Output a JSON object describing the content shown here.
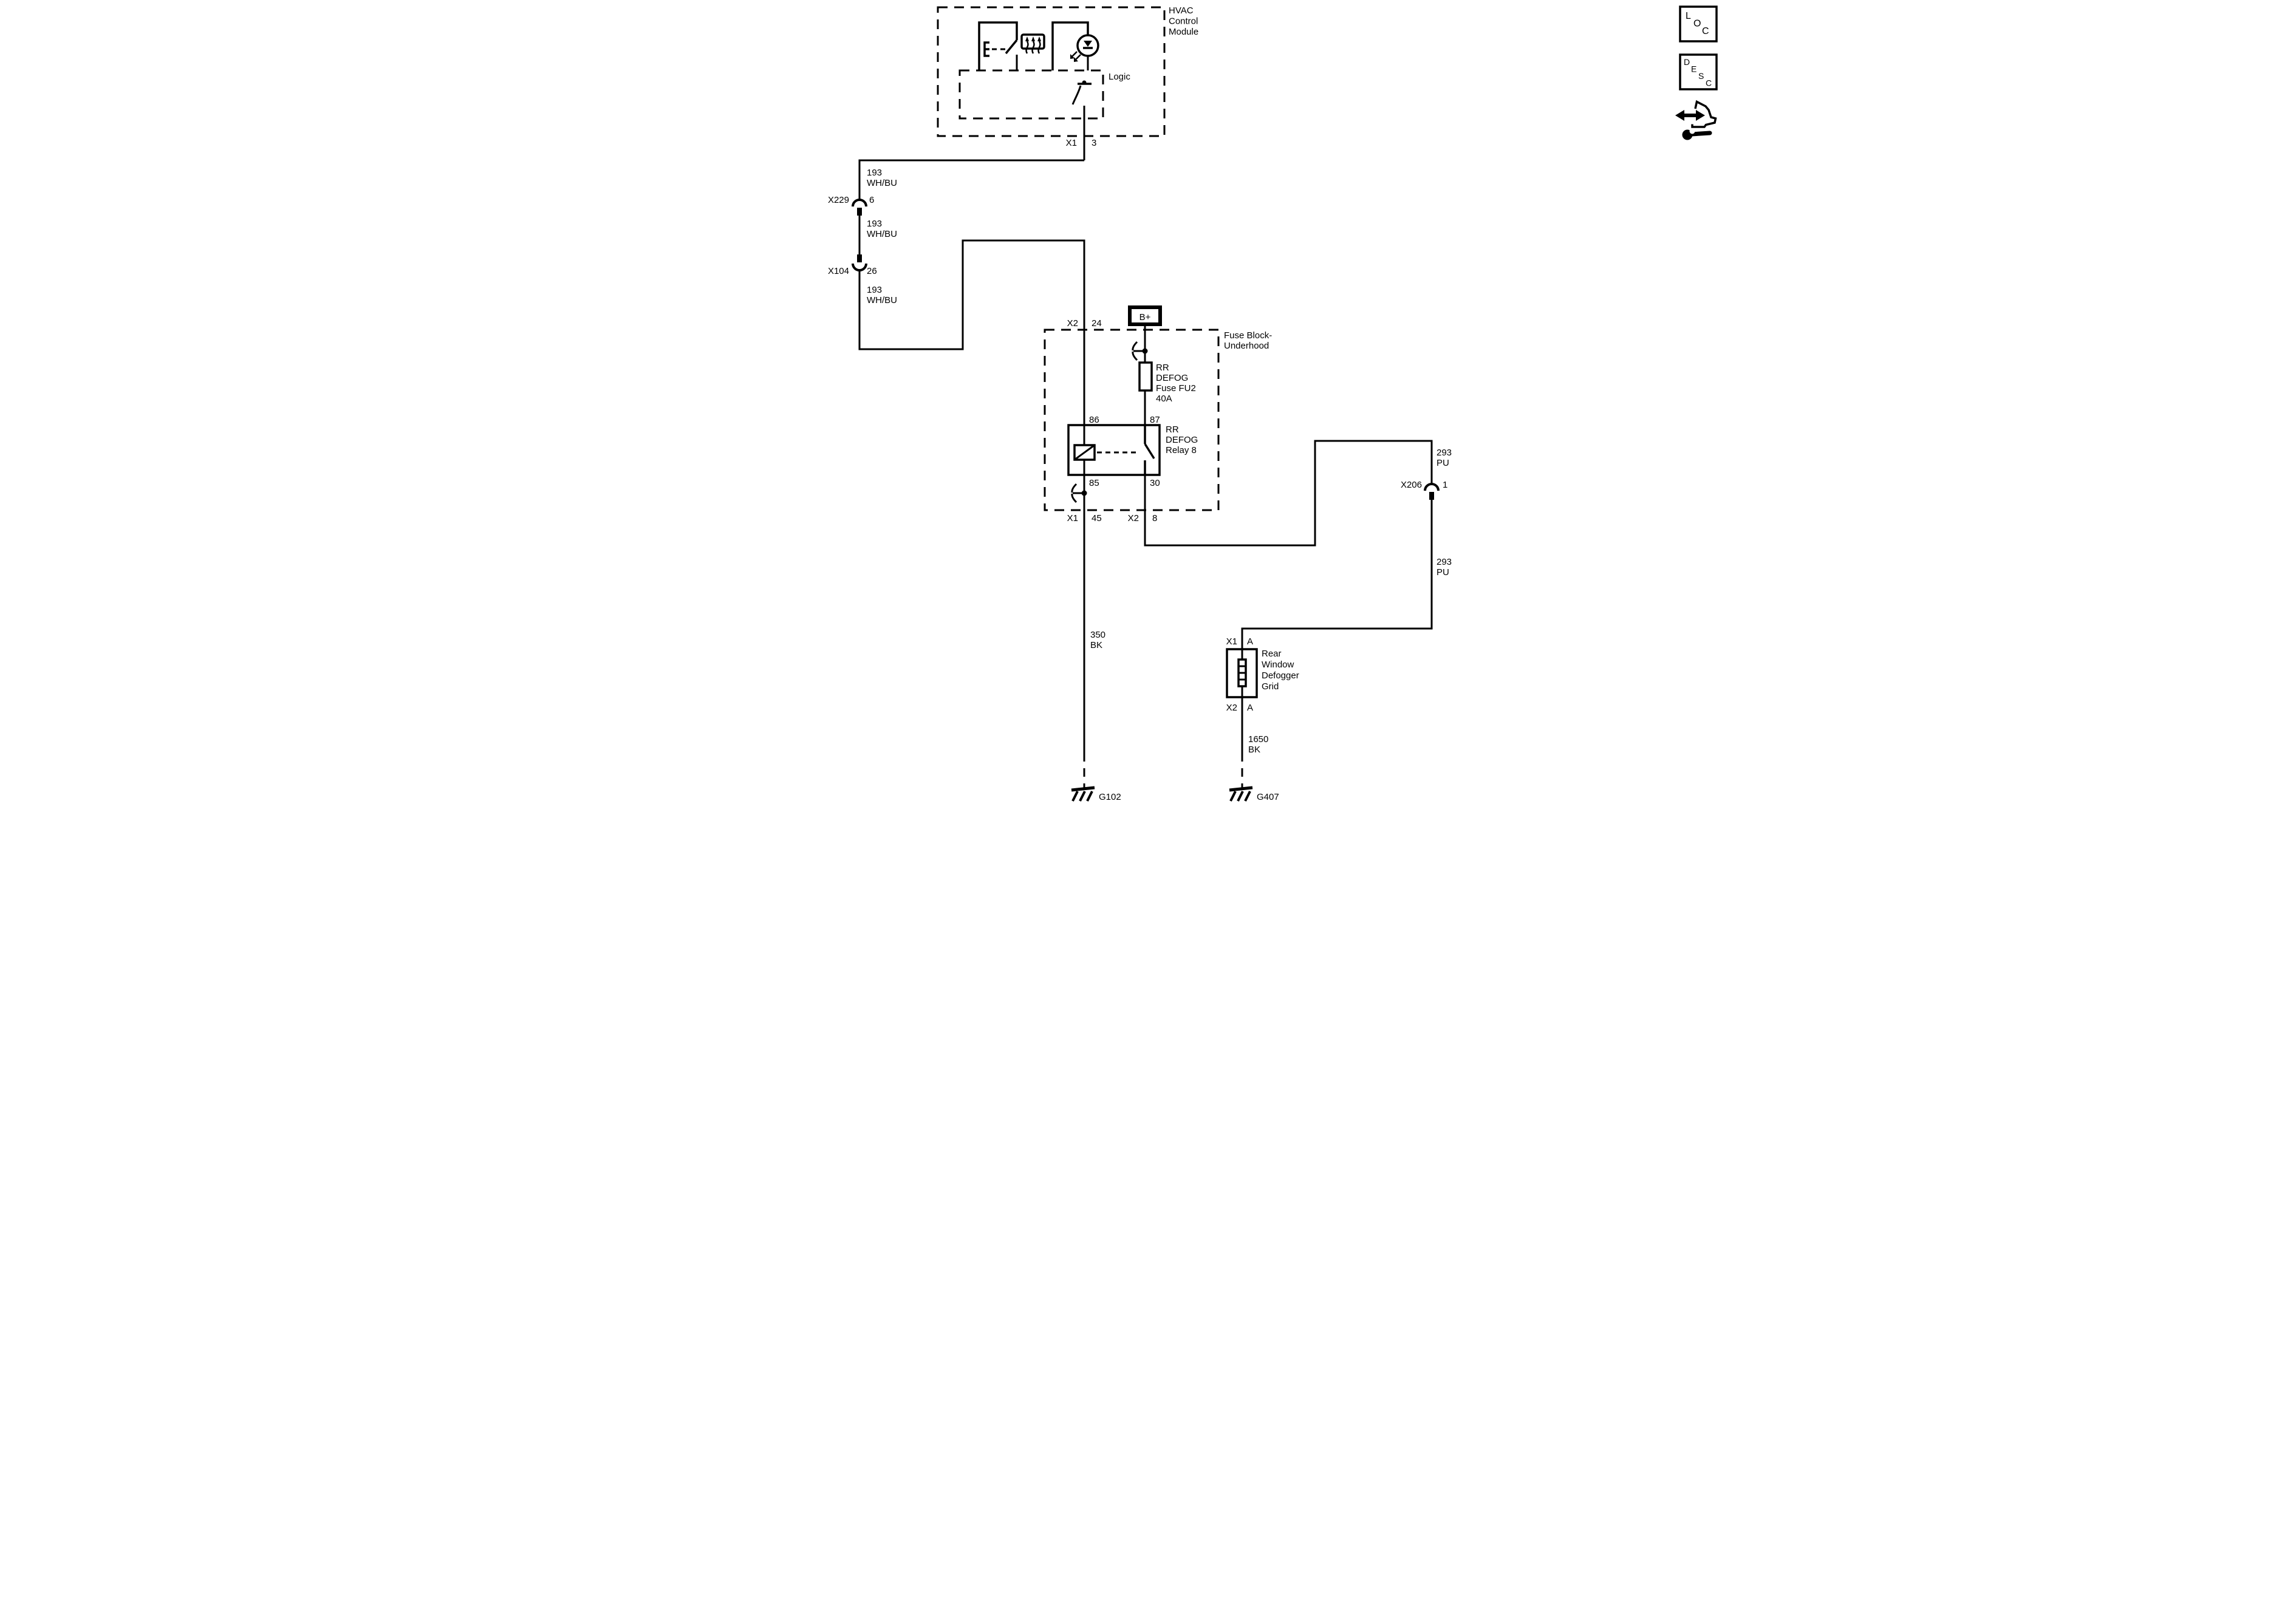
{
  "corner_panel": {
    "loc_letters": [
      "L",
      "O",
      "C"
    ],
    "desc_letters": [
      "D",
      "E",
      "S",
      "C"
    ]
  },
  "hvac_module": {
    "name_lines": [
      "HVAC",
      "Control",
      "Module"
    ],
    "logic_label": "Logic",
    "exit_connector": "X1",
    "exit_pin": "3"
  },
  "wires": {
    "w193_1": {
      "circuit": "193",
      "color": "WH/BU"
    },
    "w193_2": {
      "circuit": "193",
      "color": "WH/BU"
    },
    "w193_3": {
      "circuit": "193",
      "color": "WH/BU"
    },
    "w350": {
      "circuit": "350",
      "color": "BK"
    },
    "w293_1": {
      "circuit": "293",
      "color": "PU"
    },
    "w293_2": {
      "circuit": "293",
      "color": "PU"
    },
    "w1650": {
      "circuit": "1650",
      "color": "BK"
    }
  },
  "connectors": {
    "x229": {
      "name": "X229",
      "pin": "6"
    },
    "x104": {
      "name": "X104",
      "pin": "26"
    },
    "x206": {
      "name": "X206",
      "pin": "1"
    }
  },
  "fuse_block": {
    "name_lines": [
      "Fuse Block-",
      "Underhood"
    ],
    "entry_connector": "X2",
    "entry_pin": "24",
    "battery_label": "B+",
    "fuse_lines": [
      "RR",
      "DEFOG",
      "Fuse FU2",
      "40A"
    ],
    "relay_lines": [
      "RR",
      "DEFOG",
      "Relay 8"
    ],
    "terminals": {
      "t86": "86",
      "t87": "87",
      "t85": "85",
      "t30": "30"
    },
    "exit_left_connector": "X1",
    "exit_left_pin": "45",
    "exit_right_connector": "X2",
    "exit_right_pin": "8"
  },
  "defogger": {
    "name_lines": [
      "Rear",
      "Window",
      "Defogger",
      "Grid"
    ],
    "top_connector": "X1",
    "top_pin": "A",
    "bottom_connector": "X2",
    "bottom_pin": "A"
  },
  "grounds": {
    "left": "G102",
    "right": "G407"
  }
}
